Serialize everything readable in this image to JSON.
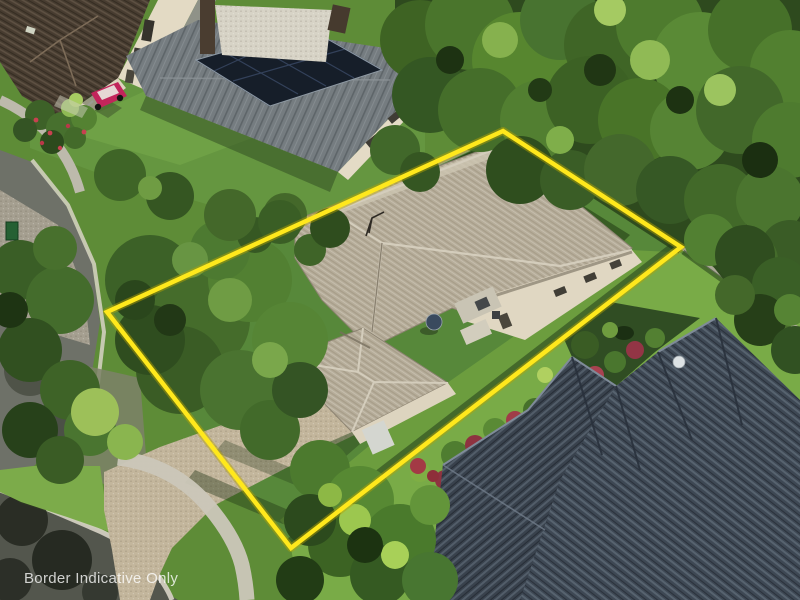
{
  "watermark": {
    "text": "Border Indicative Only",
    "color": "#ffffff",
    "opacity": 0.78
  },
  "boundary_overlay": {
    "points": "503,131 681,247 291,548 107,312",
    "color": "#ffe81c",
    "underglow_color": "#b7a400"
  },
  "palette": {
    "grass_base": "#5e8c37",
    "grass_bright": "#79ab47",
    "grass_shadow": "#26411b",
    "road_asphalt": "#6e7168",
    "road_dark": "#53564d",
    "cobble_paving": "#a59f90",
    "curb_concrete": "#d8d4c6",
    "footpath": "#c9c5b7",
    "driveway": "#c3b69c",
    "main_roof_tile": "#b6ad9a",
    "neighbor_roof_tile": "#3e4854",
    "top_house_roof": "#473c30",
    "metal_roof": "#757c80",
    "solar_panel": "#161e29",
    "wall_cream": "#e0d7c2",
    "fence_timber": "#9aa08f",
    "trailer_red": "#c2255b",
    "utility_box_green": "#256033"
  },
  "scene_objects": {
    "main_feature": "single-storey house with beige tiled hip roof inside yellow property boundary",
    "others": [
      "solar-panel house top",
      "dark-brown roof house top-left",
      "dark-grey tiled roof house bottom-right",
      "cul-de-sac road left",
      "driveway",
      "tropical garden",
      "tree canopy"
    ]
  }
}
